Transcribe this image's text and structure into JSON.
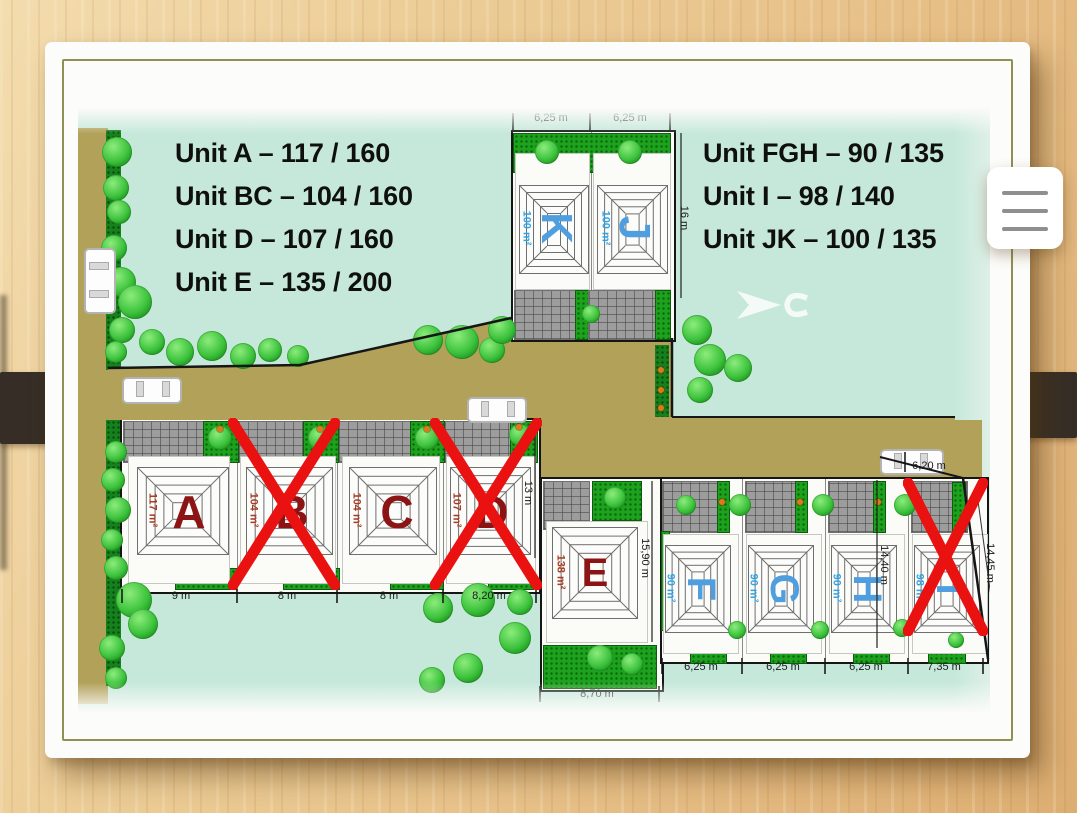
{
  "legend_left": {
    "lines": [
      "Unit A – 117 / 160",
      "Unit BC – 104 / 160",
      "Unit D – 107 / 160",
      "Unit E – 135 / 200"
    ]
  },
  "legend_right": {
    "lines": [
      "Unit FGH – 90 / 135",
      "Unit I – 98 / 140",
      "Unit JK – 100 / 135"
    ]
  },
  "plan": {
    "units": [
      {
        "id": "K",
        "letter": "K",
        "area_label": "100 m²",
        "color_group": "blue",
        "crossed": false
      },
      {
        "id": "J",
        "letter": "J",
        "area_label": "100 m²",
        "color_group": "blue",
        "crossed": false
      },
      {
        "id": "A",
        "letter": "A",
        "area_label": "117 m²",
        "color_group": "red",
        "crossed": false
      },
      {
        "id": "B",
        "letter": "B",
        "area_label": "104 m²",
        "color_group": "red",
        "crossed": true
      },
      {
        "id": "C",
        "letter": "C",
        "area_label": "104 m²",
        "color_group": "red",
        "crossed": false
      },
      {
        "id": "D",
        "letter": "D",
        "area_label": "107 m²",
        "color_group": "red",
        "crossed": true
      },
      {
        "id": "E",
        "letter": "E",
        "area_label": "138 m²",
        "color_group": "red",
        "crossed": false
      },
      {
        "id": "F",
        "letter": "F",
        "area_label": "90 m²",
        "color_group": "blue",
        "crossed": false
      },
      {
        "id": "G",
        "letter": "G",
        "area_label": "90 m²",
        "color_group": "blue",
        "crossed": false
      },
      {
        "id": "H",
        "letter": "H",
        "area_label": "90 m²",
        "color_group": "blue",
        "crossed": false
      },
      {
        "id": "I",
        "letter": "I",
        "area_label": "98 m²",
        "color_group": "blue",
        "crossed": true
      }
    ],
    "measurements": [
      {
        "id": "kj-width-left",
        "text": "6,25 m"
      },
      {
        "id": "kj-width-right",
        "text": "6,25 m"
      },
      {
        "id": "kj-depth",
        "text": "16 m"
      },
      {
        "id": "a-width",
        "text": "9 m"
      },
      {
        "id": "b-width",
        "text": "8 m"
      },
      {
        "id": "c-width",
        "text": "8 m"
      },
      {
        "id": "d-width",
        "text": "8,20 m"
      },
      {
        "id": "d-depth",
        "text": "13 m"
      },
      {
        "id": "e-depth",
        "text": "15,90 m"
      },
      {
        "id": "e-width",
        "text": "8,70 m"
      },
      {
        "id": "f-width",
        "text": "6,25 m"
      },
      {
        "id": "g-width",
        "text": "6,25 m"
      },
      {
        "id": "h-width",
        "text": "6,25 m"
      },
      {
        "id": "i-width",
        "text": "7,35 m"
      },
      {
        "id": "hi-depth",
        "text": "14,40 m"
      },
      {
        "id": "boundary-depth",
        "text": "14,45 m"
      },
      {
        "id": "road-width",
        "text": "6,20 m"
      }
    ]
  },
  "colors": {
    "teal_bg": "#c5e8da",
    "road_tan": "#b2a159",
    "red_letter": "#8c1414",
    "red_area": "#a63c22",
    "blue_letter": "#4f9fe0",
    "blue_area": "#2fa3e5",
    "cross_red": "#ea1111",
    "garden_green": "#1da21d",
    "drive_gray": "#9d9d9d"
  }
}
